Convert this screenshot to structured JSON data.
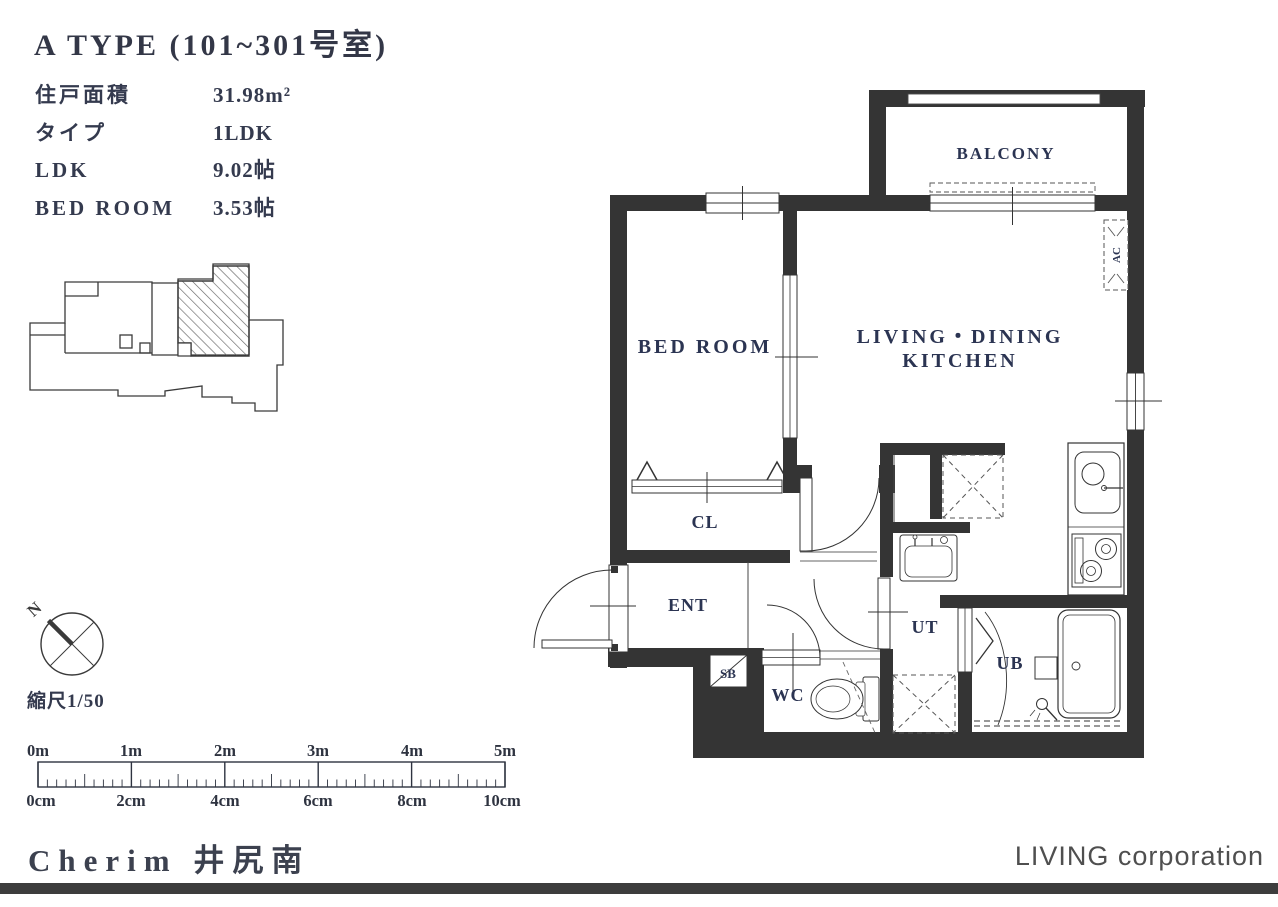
{
  "header": {
    "title": "A TYPE (101~301号室)"
  },
  "info": {
    "rows": [
      {
        "label": "住戸面積",
        "value": "31.98m²"
      },
      {
        "label": "タイプ",
        "value": "1LDK"
      },
      {
        "label": "LDK",
        "value": "9.02帖"
      },
      {
        "label": "BED ROOM",
        "value": "3.53帖"
      }
    ]
  },
  "compass": {
    "north": "N"
  },
  "scale": {
    "note": "縮尺1/50"
  },
  "ruler": {
    "meter_labels": [
      "0m",
      "1m",
      "2m",
      "3m",
      "4m",
      "5m"
    ],
    "cm_labels": [
      "0cm",
      "2cm",
      "4cm",
      "6cm",
      "8cm",
      "10cm"
    ]
  },
  "plan": {
    "labels": {
      "balcony": "BALCONY",
      "bedroom": "BED ROOM",
      "ldk_line1": "LIVING・DINING",
      "ldk_line2": "KITCHEN",
      "closet": "CL",
      "entrance": "ENT",
      "shoebox": "SB",
      "toilet": "WC",
      "utility": "UT",
      "bath": "UB",
      "ac": "AC"
    }
  },
  "footer": {
    "building": "Cherim 井尻南",
    "company": "LIVING corporation"
  },
  "colors": {
    "wall": "#343434",
    "label_text": "#2b3452",
    "footer_bar": "#3d3d3d"
  }
}
